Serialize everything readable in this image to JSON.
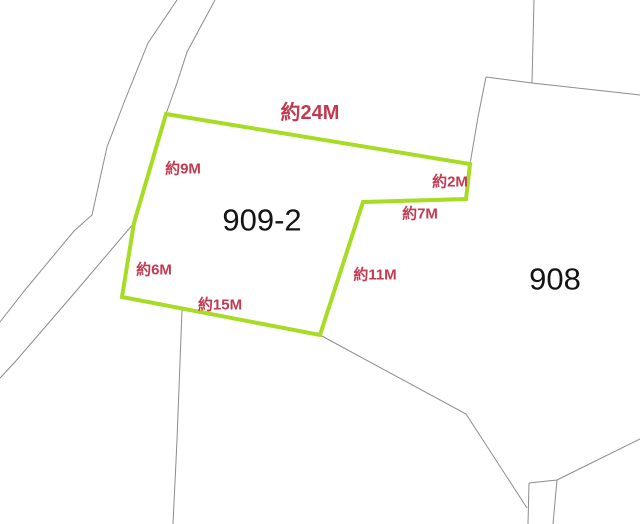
{
  "map": {
    "background_color": "#ffffff",
    "boundary_line_color": "#8c8c8c",
    "highlight_color": "#a6dc23",
    "dimension_text_color": "#c23a50",
    "parcel_text_color": "#141414",
    "parcels": [
      {
        "number": "909-2",
        "label_x": 262,
        "label_y": 220,
        "font_size": 31
      },
      {
        "number": "908",
        "label_x": 555,
        "label_y": 279,
        "font_size": 31
      }
    ],
    "highlighted_parcel": {
      "parcel_number": "909-2",
      "outline_points": [
        [
          166,
          114
        ],
        [
          470,
          164
        ],
        [
          466,
          199
        ],
        [
          363,
          202
        ],
        [
          320,
          335
        ],
        [
          122,
          297
        ],
        [
          134,
          223
        ]
      ],
      "stroke_width": 4
    },
    "dimension_labels": [
      {
        "text": "約24M",
        "x": 310,
        "y": 113,
        "font_size": 20
      },
      {
        "text": "約9M",
        "x": 183,
        "y": 169,
        "font_size": 15
      },
      {
        "text": "約2M",
        "x": 450,
        "y": 182,
        "font_size": 15
      },
      {
        "text": "約7M",
        "x": 420,
        "y": 214,
        "font_size": 15
      },
      {
        "text": "約11M",
        "x": 375,
        "y": 275,
        "font_size": 15
      },
      {
        "text": "約6M",
        "x": 154,
        "y": 270,
        "font_size": 15
      },
      {
        "text": "約15M",
        "x": 220,
        "y": 305,
        "font_size": 15
      }
    ],
    "boundary_lines": [
      {
        "name": "road-left-edge",
        "points": [
          [
            177,
            0
          ],
          [
            148,
            43
          ],
          [
            125,
            100
          ],
          [
            107,
            147
          ],
          [
            92,
            215
          ],
          [
            74,
            231
          ],
          [
            25,
            290
          ],
          [
            0,
            322
          ]
        ]
      },
      {
        "name": "road-right-edge-upper",
        "points": [
          [
            215,
            0
          ],
          [
            187,
            52
          ],
          [
            177,
            83
          ],
          [
            166,
            114
          ]
        ]
      },
      {
        "name": "road-right-edge-covered",
        "points": [
          [
            166,
            114
          ],
          [
            134,
            223
          ]
        ]
      },
      {
        "name": "road-right-edge-lower",
        "points": [
          [
            134,
            223
          ],
          [
            77,
            290
          ],
          [
            15,
            362
          ],
          [
            0,
            378
          ]
        ]
      },
      {
        "name": "north-vertical-boundary",
        "points": [
          [
            534,
            0
          ],
          [
            532,
            83
          ]
        ]
      },
      {
        "name": "north-east-boundary",
        "points": [
          [
            486,
            77
          ],
          [
            532,
            83
          ],
          [
            640,
            95
          ]
        ]
      },
      {
        "name": "west-908-boundary",
        "points": [
          [
            486,
            77
          ],
          [
            478,
            117
          ],
          [
            470,
            164
          ]
        ]
      },
      {
        "name": "south-vertical-boundary",
        "points": [
          [
            182,
            310
          ],
          [
            177,
            440
          ],
          [
            173,
            524
          ]
        ]
      },
      {
        "name": "south-908-boundary",
        "points": [
          [
            320,
            335
          ],
          [
            466,
            414
          ],
          [
            527,
            508
          ]
        ]
      },
      {
        "name": "strip-left-edge",
        "points": [
          [
            529,
            483
          ],
          [
            528,
            524
          ]
        ]
      },
      {
        "name": "strip-right-edge",
        "points": [
          [
            557,
            480
          ],
          [
            553,
            524
          ]
        ]
      },
      {
        "name": "strip-top-edge",
        "points": [
          [
            529,
            483
          ],
          [
            557,
            480
          ]
        ]
      },
      {
        "name": "southeast-boundary",
        "points": [
          [
            640,
            439
          ],
          [
            557,
            480
          ]
        ]
      }
    ]
  }
}
